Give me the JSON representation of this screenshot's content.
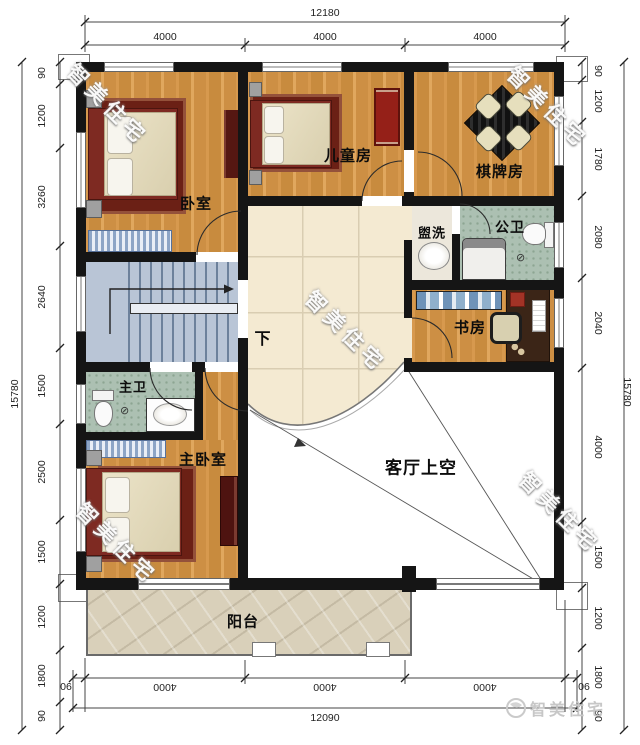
{
  "plan_title": "二层平面布局图",
  "dimensions": {
    "top": {
      "total": "12180",
      "segments": [
        "4000",
        "4000",
        "4000"
      ]
    },
    "bottom": {
      "total": "12090",
      "segments": [
        "4000",
        "4000",
        "4000"
      ],
      "offsets": [
        "90",
        "90"
      ]
    },
    "left": {
      "total": "15780",
      "segments": [
        "90",
        "1200",
        "3260",
        "2640",
        "1500",
        "2500",
        "1500",
        "1200",
        "1800",
        "90"
      ]
    },
    "right": {
      "total": "15780",
      "segments": [
        "90",
        "1200",
        "1780",
        "2080",
        "2040",
        "4000",
        "1500",
        "1200",
        "1800",
        "90"
      ]
    }
  },
  "rooms": {
    "bedroom": "卧室",
    "kids_room": "儿童房",
    "chess_room": "棋牌房",
    "wash_area": "盥洗",
    "public_bath": "公卫",
    "study": "书房",
    "master_bath": "主卫",
    "master_bedroom": "主卧室",
    "living_void": "客厅上空",
    "balcony": "阳台",
    "stairs_down": "下"
  },
  "watermark": {
    "text": "智美住宅"
  },
  "colors": {
    "wall": "#151515",
    "wood_floor": "#cf9145",
    "hall_tile": "#f4ead2",
    "bath_tile": "#acc0b2",
    "stair_floor": "#b9c5d6",
    "balcony_stone": "#d9d0ba",
    "bed_frame_red": "#7e2a22",
    "cabinet_dark_red": "#551712"
  }
}
